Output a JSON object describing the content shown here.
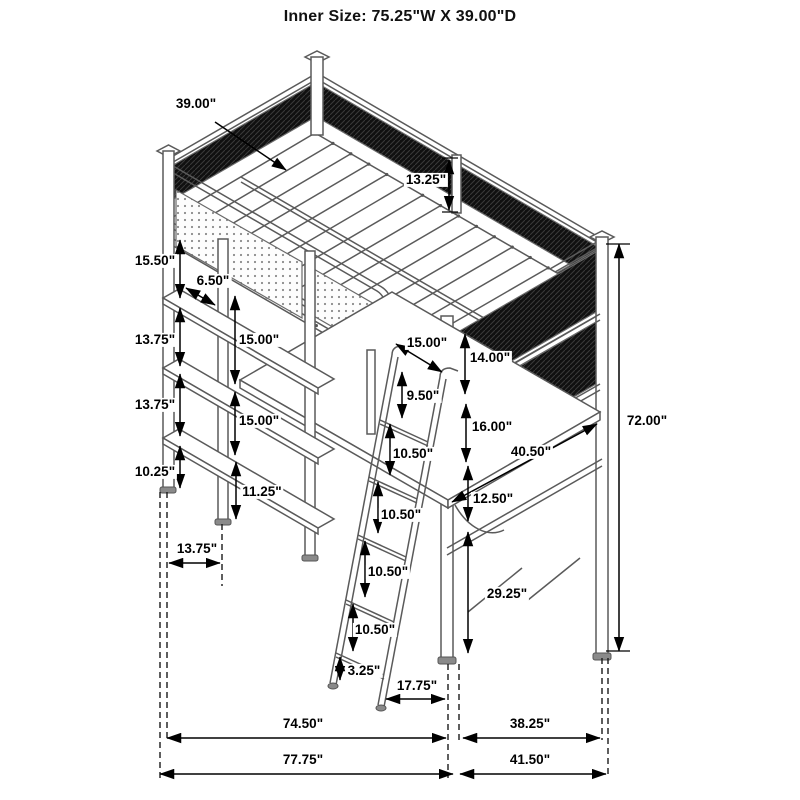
{
  "title": "Inner Size: 75.25\"W X 39.00\"D",
  "colors": {
    "line": "#5a5a5a",
    "mesh": "#101010",
    "dimension": "#000000",
    "background": "#ffffff"
  },
  "dimensions": [
    {
      "label": "39.00\"",
      "x": 196,
      "y": 104,
      "arrow": {
        "x1": 215,
        "y1": 122,
        "x2": 286,
        "y2": 170,
        "heads": "end"
      }
    },
    {
      "label": "13.25\"",
      "x": 426,
      "y": 180,
      "arrow": {
        "x1": 449,
        "y1": 160,
        "x2": 449,
        "y2": 210,
        "heads": "both"
      }
    },
    {
      "label": "15.50\"",
      "x": 155,
      "y": 261,
      "arrow": {
        "x1": 180,
        "y1": 240,
        "x2": 180,
        "y2": 298,
        "heads": "both"
      }
    },
    {
      "label": "6.50\"",
      "x": 213,
      "y": 281,
      "arrow": {
        "x1": 186,
        "y1": 288,
        "x2": 215,
        "y2": 305,
        "heads": "both"
      }
    },
    {
      "label": "13.75\"",
      "x": 155,
      "y": 340,
      "arrow": {
        "x1": 180,
        "y1": 308,
        "x2": 180,
        "y2": 366,
        "heads": "both"
      }
    },
    {
      "label": "15.00\"",
      "x": 259,
      "y": 340,
      "arrow": {
        "x1": 235,
        "y1": 296,
        "x2": 235,
        "y2": 384,
        "heads": "both"
      }
    },
    {
      "label": "13.75\"",
      "x": 155,
      "y": 405,
      "arrow": {
        "x1": 180,
        "y1": 374,
        "x2": 180,
        "y2": 436,
        "heads": "both"
      }
    },
    {
      "label": "15.00\"",
      "x": 259,
      "y": 421,
      "arrow": {
        "x1": 235,
        "y1": 392,
        "x2": 235,
        "y2": 455,
        "heads": "both"
      }
    },
    {
      "label": "10.25\"",
      "x": 155,
      "y": 472,
      "arrow": {
        "x1": 180,
        "y1": 446,
        "x2": 180,
        "y2": 488,
        "heads": "both"
      }
    },
    {
      "label": "11.25\"",
      "x": 262,
      "y": 492,
      "arrow": {
        "x1": 236,
        "y1": 462,
        "x2": 236,
        "y2": 519,
        "heads": "both"
      }
    },
    {
      "label": "13.75\"",
      "x": 197,
      "y": 549,
      "arrow": {
        "x1": 169,
        "y1": 563,
        "x2": 220,
        "y2": 563,
        "heads": "both"
      }
    },
    {
      "label": "15.00\"",
      "x": 427,
      "y": 343,
      "arrow": {
        "x1": 396,
        "y1": 344,
        "x2": 442,
        "y2": 372,
        "heads": "both"
      }
    },
    {
      "label": "14.00\"",
      "x": 490,
      "y": 358,
      "arrow": {
        "x1": 465,
        "y1": 334,
        "x2": 465,
        "y2": 394,
        "heads": "both"
      }
    },
    {
      "label": "9.50\"",
      "x": 423,
      "y": 396,
      "arrow": {
        "x1": 402,
        "y1": 372,
        "x2": 402,
        "y2": 418,
        "heads": "both"
      }
    },
    {
      "label": "16.00\"",
      "x": 492,
      "y": 427,
      "arrow": {
        "x1": 466,
        "y1": 404,
        "x2": 466,
        "y2": 462,
        "heads": "both"
      }
    },
    {
      "label": "10.50\"",
      "x": 413,
      "y": 454,
      "arrow": {
        "x1": 390,
        "y1": 424,
        "x2": 390,
        "y2": 475,
        "heads": "both"
      }
    },
    {
      "label": "40.50\"",
      "x": 531,
      "y": 452,
      "arrow": {
        "x1": 452,
        "y1": 502,
        "x2": 597,
        "y2": 424,
        "heads": "both"
      }
    },
    {
      "label": "12.50\"",
      "x": 493,
      "y": 499,
      "arrow": {
        "x1": 468,
        "y1": 466,
        "x2": 468,
        "y2": 521,
        "heads": "both"
      }
    },
    {
      "label": "10.50\"",
      "x": 401,
      "y": 515,
      "arrow": {
        "x1": 378,
        "y1": 482,
        "x2": 378,
        "y2": 533,
        "heads": "both"
      }
    },
    {
      "label": "10.50\"",
      "x": 388,
      "y": 572,
      "arrow": {
        "x1": 365,
        "y1": 541,
        "x2": 365,
        "y2": 597,
        "heads": "both"
      }
    },
    {
      "label": "10.50\"",
      "x": 375,
      "y": 630,
      "arrow": {
        "x1": 353,
        "y1": 604,
        "x2": 353,
        "y2": 651,
        "heads": "both"
      }
    },
    {
      "label": "3.25\"",
      "x": 364,
      "y": 671,
      "arrow": {
        "x1": 340,
        "y1": 657,
        "x2": 340,
        "y2": 680,
        "heads": "both"
      }
    },
    {
      "label": "17.75\"",
      "x": 417,
      "y": 686,
      "arrow": {
        "x1": 386,
        "y1": 699,
        "x2": 445,
        "y2": 699,
        "heads": "both"
      }
    },
    {
      "label": "29.25\"",
      "x": 507,
      "y": 594,
      "arrow": {
        "x1": 468,
        "y1": 532,
        "x2": 468,
        "y2": 653,
        "heads": "both"
      }
    },
    {
      "label": "72.00\"",
      "x": 647,
      "y": 421,
      "arrow": {
        "x1": 619,
        "y1": 244,
        "x2": 619,
        "y2": 651,
        "heads": "both"
      }
    },
    {
      "label": "74.50\"",
      "x": 303,
      "y": 724,
      "arrow": {
        "x1": 167,
        "y1": 738,
        "x2": 446,
        "y2": 738,
        "heads": "both"
      }
    },
    {
      "label": "38.25\"",
      "x": 530,
      "y": 724,
      "arrow": {
        "x1": 463,
        "y1": 738,
        "x2": 600,
        "y2": 738,
        "heads": "both"
      }
    },
    {
      "label": "77.75\"",
      "x": 303,
      "y": 760,
      "arrow": {
        "x1": 160,
        "y1": 774,
        "x2": 453,
        "y2": 774,
        "heads": "both"
      }
    },
    {
      "label": "41.50\"",
      "x": 530,
      "y": 760,
      "arrow": {
        "x1": 460,
        "y1": 774,
        "x2": 606,
        "y2": 774,
        "heads": "both"
      }
    }
  ]
}
